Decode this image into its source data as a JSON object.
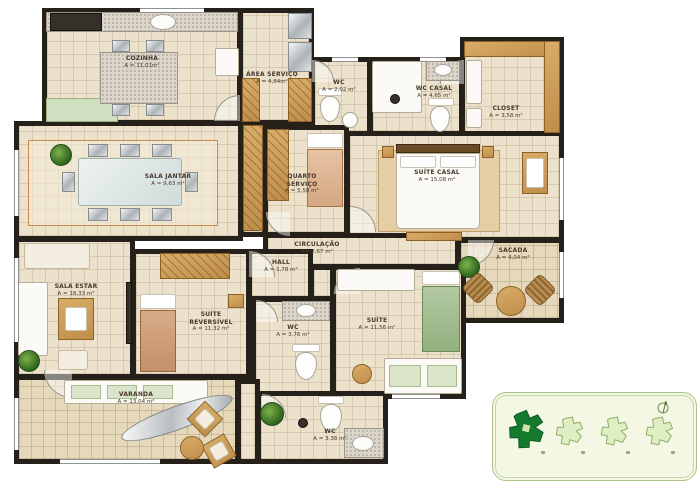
{
  "rooms": [
    {
      "id": "cozinha",
      "name": "COZINHA",
      "area": "A = 11,01m²"
    },
    {
      "id": "area-servico",
      "name": "ÁREA SERVIÇO",
      "area": "A = 4,84m²"
    },
    {
      "id": "wc-servico",
      "name": "WC",
      "area": "A = 2,02 m²"
    },
    {
      "id": "wc-casal",
      "name": "WC CASAL",
      "area": "A = 4,65 m²"
    },
    {
      "id": "closet",
      "name": "CLOSET",
      "area": "A = 3,58 m²"
    },
    {
      "id": "sala-jantar",
      "name": "SALA JANTAR",
      "area": "A = 9,63 m²"
    },
    {
      "id": "quarto-servico",
      "name": "QUARTO SERVIÇO",
      "area": "A = 5,58 m²"
    },
    {
      "id": "suite-casal",
      "name": "SUÍTE CASAL",
      "area": "A = 15,08 m²"
    },
    {
      "id": "circulacao",
      "name": "CIRCULAÇÃO",
      "area": "A= 2,67 m²"
    },
    {
      "id": "sacada",
      "name": "SACADA",
      "area": "A = 4,04 m²"
    },
    {
      "id": "sala-estar",
      "name": "SALA ESTAR",
      "area": "A = 18,33 m²"
    },
    {
      "id": "hall",
      "name": "HALL",
      "area": "A = 1,78 m²"
    },
    {
      "id": "suite-reversivel",
      "name": "SUÍTE REVERSÍVEL",
      "area": "A = 11,32 m²"
    },
    {
      "id": "wc-hall",
      "name": "WC",
      "area": "A = 3,76 m²"
    },
    {
      "id": "suite",
      "name": "SUÍTE",
      "area": "A = 11,56 m²"
    },
    {
      "id": "varanda",
      "name": "VARANDA",
      "area": "A = 13,04 m²"
    },
    {
      "id": "wc-suite",
      "name": "WC",
      "area": "A = 3,38 m²"
    }
  ],
  "keyplan": {
    "building_count": 4,
    "highlighted_position": 1,
    "icons": [
      "building-footprint",
      "compass-icon"
    ]
  },
  "colors": {
    "wall": "#26201a",
    "floor": "#ece2cc",
    "wood": "#c9995c",
    "keyplan_bg": "#f3f7e3",
    "keyplan_dark": "#157a2e",
    "keyplan_light": "#dfeec3",
    "plant_green": "#2e621c",
    "rug_border_orange": "#cd8a4f"
  }
}
